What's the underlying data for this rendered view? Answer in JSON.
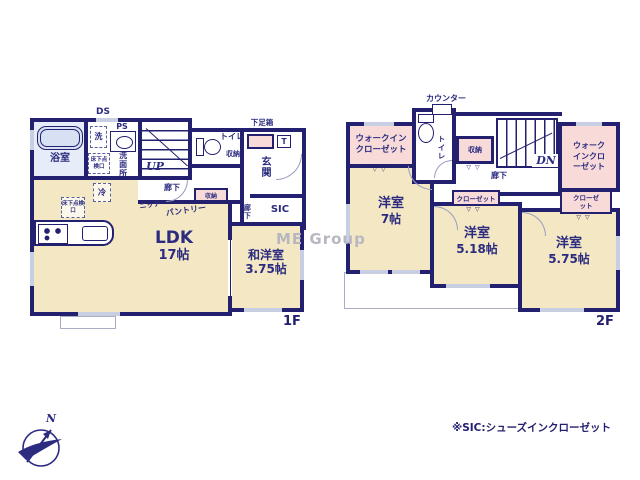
{
  "colors": {
    "wall": "#23206f",
    "room_floor": "#f4e7c3",
    "closet_floor": "#f8dbd8",
    "bath_floor": "#e6edf8",
    "text": "#2b2b80"
  },
  "common": {
    "storage": "収納",
    "closet": "クローゼット",
    "hallway": "廊下",
    "toilet": "トイレ",
    "hatch": "床下点検口",
    "door_mark": "▽▽"
  },
  "floor1": {
    "tag": "1F",
    "ds": "DS",
    "ps": "PS",
    "wash_machine": "洗",
    "bathroom": "浴室",
    "washroom": "洗面所",
    "fridge": "冷",
    "up": "UP",
    "niche": "ニッチ",
    "pantry": "パントリー",
    "shoebox": "下足箱",
    "t_box": "T",
    "genkan": "玄関",
    "sic": "SIC",
    "ldk": {
      "name": "LDK",
      "size": "17帖"
    },
    "washitsu": {
      "name": "和洋室",
      "size": "3.75帖"
    }
  },
  "floor2": {
    "tag": "2F",
    "counter": "カウンター",
    "dn": "DN",
    "wic_left": "ウォークインクローゼット",
    "wic_right": "ウォークインクローゼット",
    "room7": {
      "name": "洋室",
      "size": "7帖"
    },
    "room518": {
      "name": "洋室",
      "size": "5.18帖"
    },
    "room575": {
      "name": "洋室",
      "size": "5.75帖"
    }
  },
  "footer": {
    "note": "※SIC:シューズインクローゼット",
    "compass_north": "N"
  },
  "watermark": "ME Group"
}
